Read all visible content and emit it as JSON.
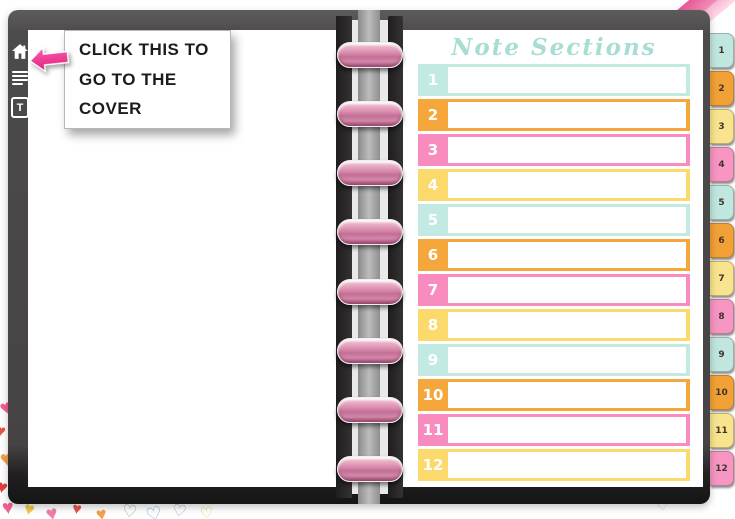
{
  "sidebar": {
    "icons": [
      {
        "name": "home-icon"
      },
      {
        "name": "list-icon"
      },
      {
        "name": "text-tool-icon",
        "label": "T"
      }
    ]
  },
  "annotation": {
    "line1": "CLICK THIS TO",
    "line2": "GO TO THE COVER",
    "arrow_color": "#f03b90"
  },
  "right_page": {
    "title": "Note Sections",
    "title_color": "#a7ddd3",
    "rows": [
      {
        "number": "1",
        "color": "#c3eae2"
      },
      {
        "number": "2",
        "color": "#f6a73c"
      },
      {
        "number": "3",
        "color": "#f98cbe"
      },
      {
        "number": "4",
        "color": "#fcd96b"
      },
      {
        "number": "5",
        "color": "#c3eae2"
      },
      {
        "number": "6",
        "color": "#f6a73c"
      },
      {
        "number": "7",
        "color": "#f98cbe"
      },
      {
        "number": "8",
        "color": "#fcd96b"
      },
      {
        "number": "9",
        "color": "#c3eae2"
      },
      {
        "number": "10",
        "color": "#f6a73c"
      },
      {
        "number": "11",
        "color": "#f98cbe"
      },
      {
        "number": "12",
        "color": "#fcd96b"
      }
    ]
  },
  "tabs": [
    {
      "label": "1",
      "color": "#bfe7df"
    },
    {
      "label": "2",
      "color": "#f2a136"
    },
    {
      "label": "3",
      "color": "#f8e48e"
    },
    {
      "label": "4",
      "color": "#f795c3"
    },
    {
      "label": "5",
      "color": "#bfe7df"
    },
    {
      "label": "6",
      "color": "#f2a136"
    },
    {
      "label": "7",
      "color": "#f8e48e"
    },
    {
      "label": "8",
      "color": "#f795c3"
    },
    {
      "label": "9",
      "color": "#bfe7df"
    },
    {
      "label": "10",
      "color": "#f2a136"
    },
    {
      "label": "11",
      "color": "#f8e48e"
    },
    {
      "label": "12",
      "color": "#f795c3"
    }
  ],
  "decor": {
    "heart": "♥",
    "heart_outline": "♡"
  },
  "colors": {
    "mint": "#c3eae2",
    "orange": "#f6a73c",
    "pink": "#f98cbe",
    "yellow": "#fcd96b",
    "ring_pink": "#d88aab",
    "frame_gray": "#4c4a4a"
  }
}
